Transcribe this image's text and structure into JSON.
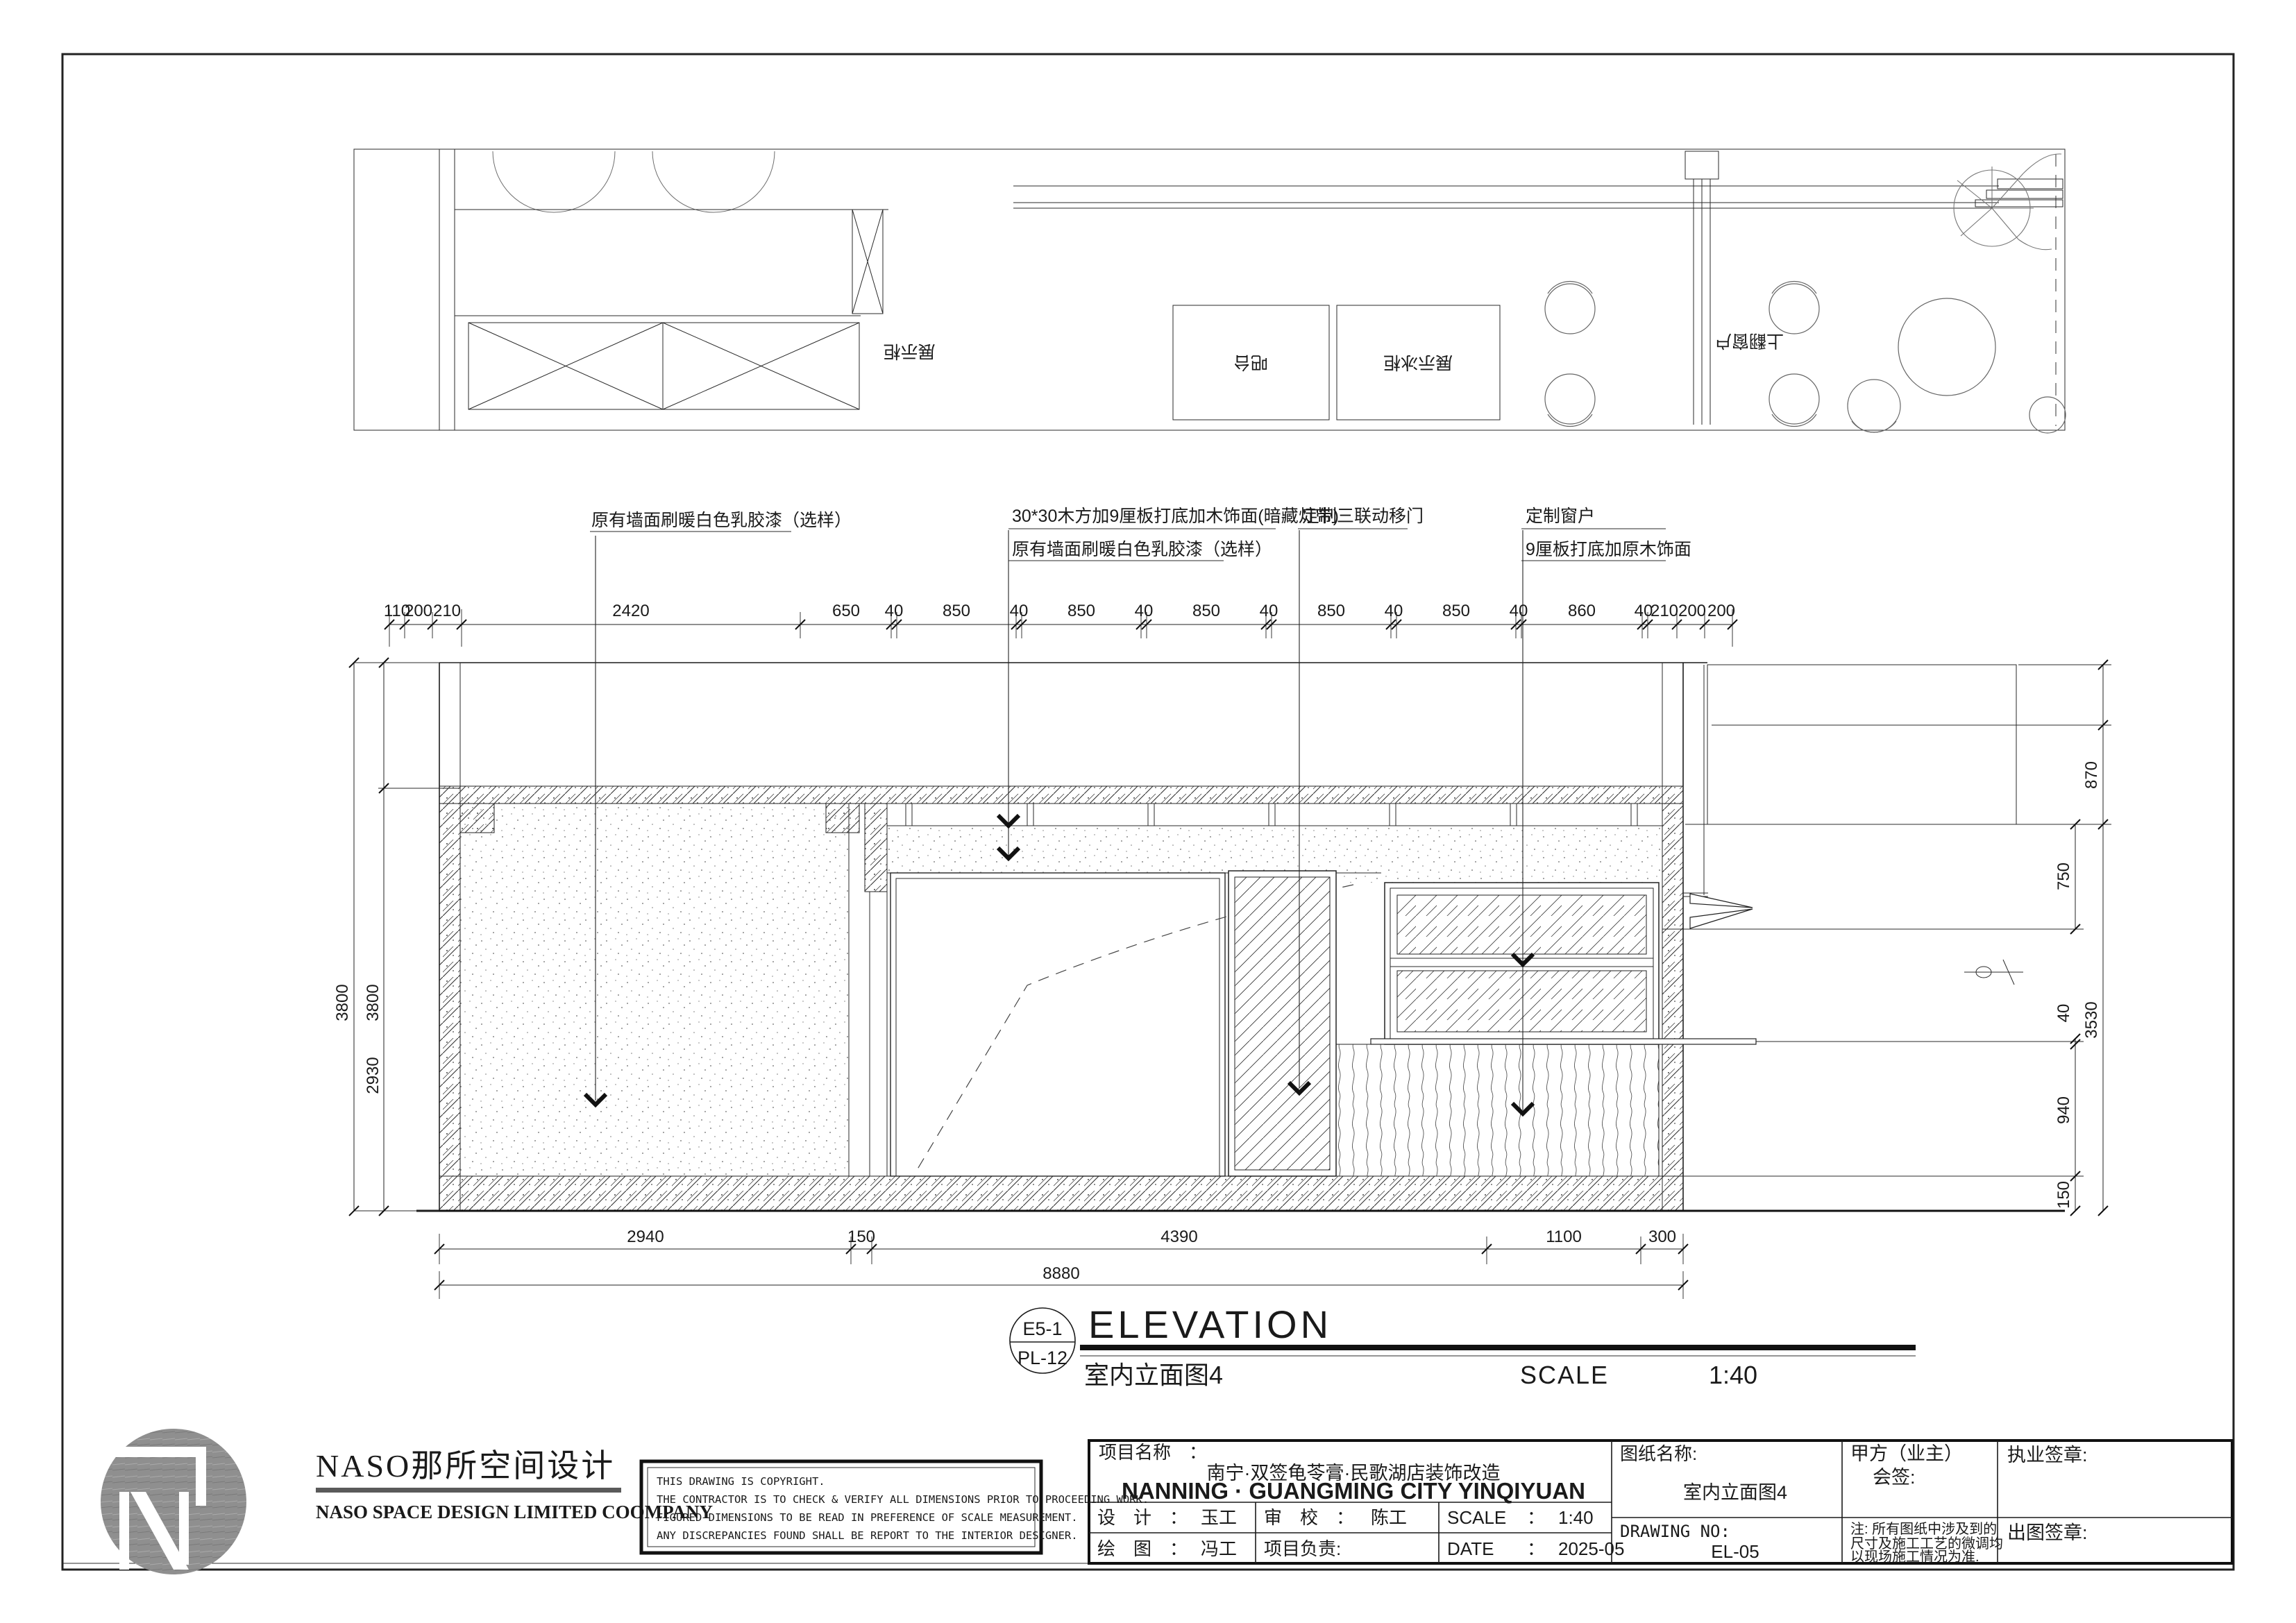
{
  "plan": {
    "labels": {
      "cabinet": "展示柜",
      "bar": "吧台",
      "freezer": "展示冰柜",
      "window": "上翻窗户"
    }
  },
  "annotations": {
    "a1": "原有墙面刷暖白色乳胶漆（选样）",
    "a2a": "30*30木方加9厘板打底加木饰面(暗藏灯带)",
    "a2b": "原有墙面刷暖白色乳胶漆（选样）",
    "a3": "定制三联动移门",
    "a4a": "定制窗户",
    "a4b": "9厘板打底加原木饰面"
  },
  "dims": {
    "top": [
      "110",
      "200",
      "210",
      "2420",
      "650",
      "40",
      "850",
      "40",
      "850",
      "40",
      "850",
      "40",
      "850",
      "40",
      "850",
      "40",
      "860",
      "40",
      "210",
      "200",
      "200"
    ],
    "bottom": [
      "2940",
      "150",
      "4390",
      "1100",
      "300"
    ],
    "total": "8880",
    "left": [
      "3800",
      "3800",
      "2930"
    ],
    "right": [
      "870",
      "750",
      "3530",
      "40",
      "940",
      "150"
    ]
  },
  "title": {
    "bubble_top": "E5-1",
    "bubble_bottom": "PL-12",
    "name_en": "ELEVATION",
    "name_cn": "室内立面图4",
    "scale_label": "SCALE",
    "scale_value": "1:40"
  },
  "logo": {
    "cn": "NASO那所空间设计",
    "en": "NASO  SPACE  DESIGN  LIMITED  COOMPANY"
  },
  "copyright": {
    "l1": "THIS DRAWING IS COPYRIGHT.",
    "l2": "THE CONTRACTOR IS TO CHECK & VERIFY ALL DIMENSIONS PRIOR TO PROCEEDING WORK.",
    "l3": "FIGURED DIMENSIONS TO BE READ IN PREFERENCE OF SCALE MEASUREMENT.",
    "l4": "ANY DISCREPANCIES FOUND SHALL BE REPORT TO THE INTERIOR DESIGNER."
  },
  "titleblock": {
    "project_label": "项目名称　：",
    "project_cn": "南宁·双签龟苓膏·民歌湖店装饰改造",
    "project_en": "NANNING · GUANGMING CITY YINQIYUAN",
    "design_label": "设　计　：",
    "design_value": "玉工",
    "check_label": "审　校　：",
    "check_value": "陈工",
    "scale_label": "SCALE",
    "scale_sep": "：",
    "scale_value": "1:40",
    "draw_label": "绘　图　：",
    "draw_value": "冯工",
    "pm_label": "项目负责:",
    "date_label": "DATE",
    "date_sep": "：",
    "date_value": "2025-05",
    "sheet_label": "图纸名称:",
    "sheet_value": "室内立面图4",
    "party_label": "甲方（业主）",
    "party_sub": "会签:",
    "sign_label": "执业签章:",
    "dwgno_label": "DRAWING NO:",
    "dwgno_value": "EL-05",
    "note_l1": "注: 所有图纸中涉及到的",
    "note_l2": "尺寸及施工工艺的微调均",
    "note_l3": "以现场施工情况为准.",
    "stamp_label": "出图签章:"
  }
}
